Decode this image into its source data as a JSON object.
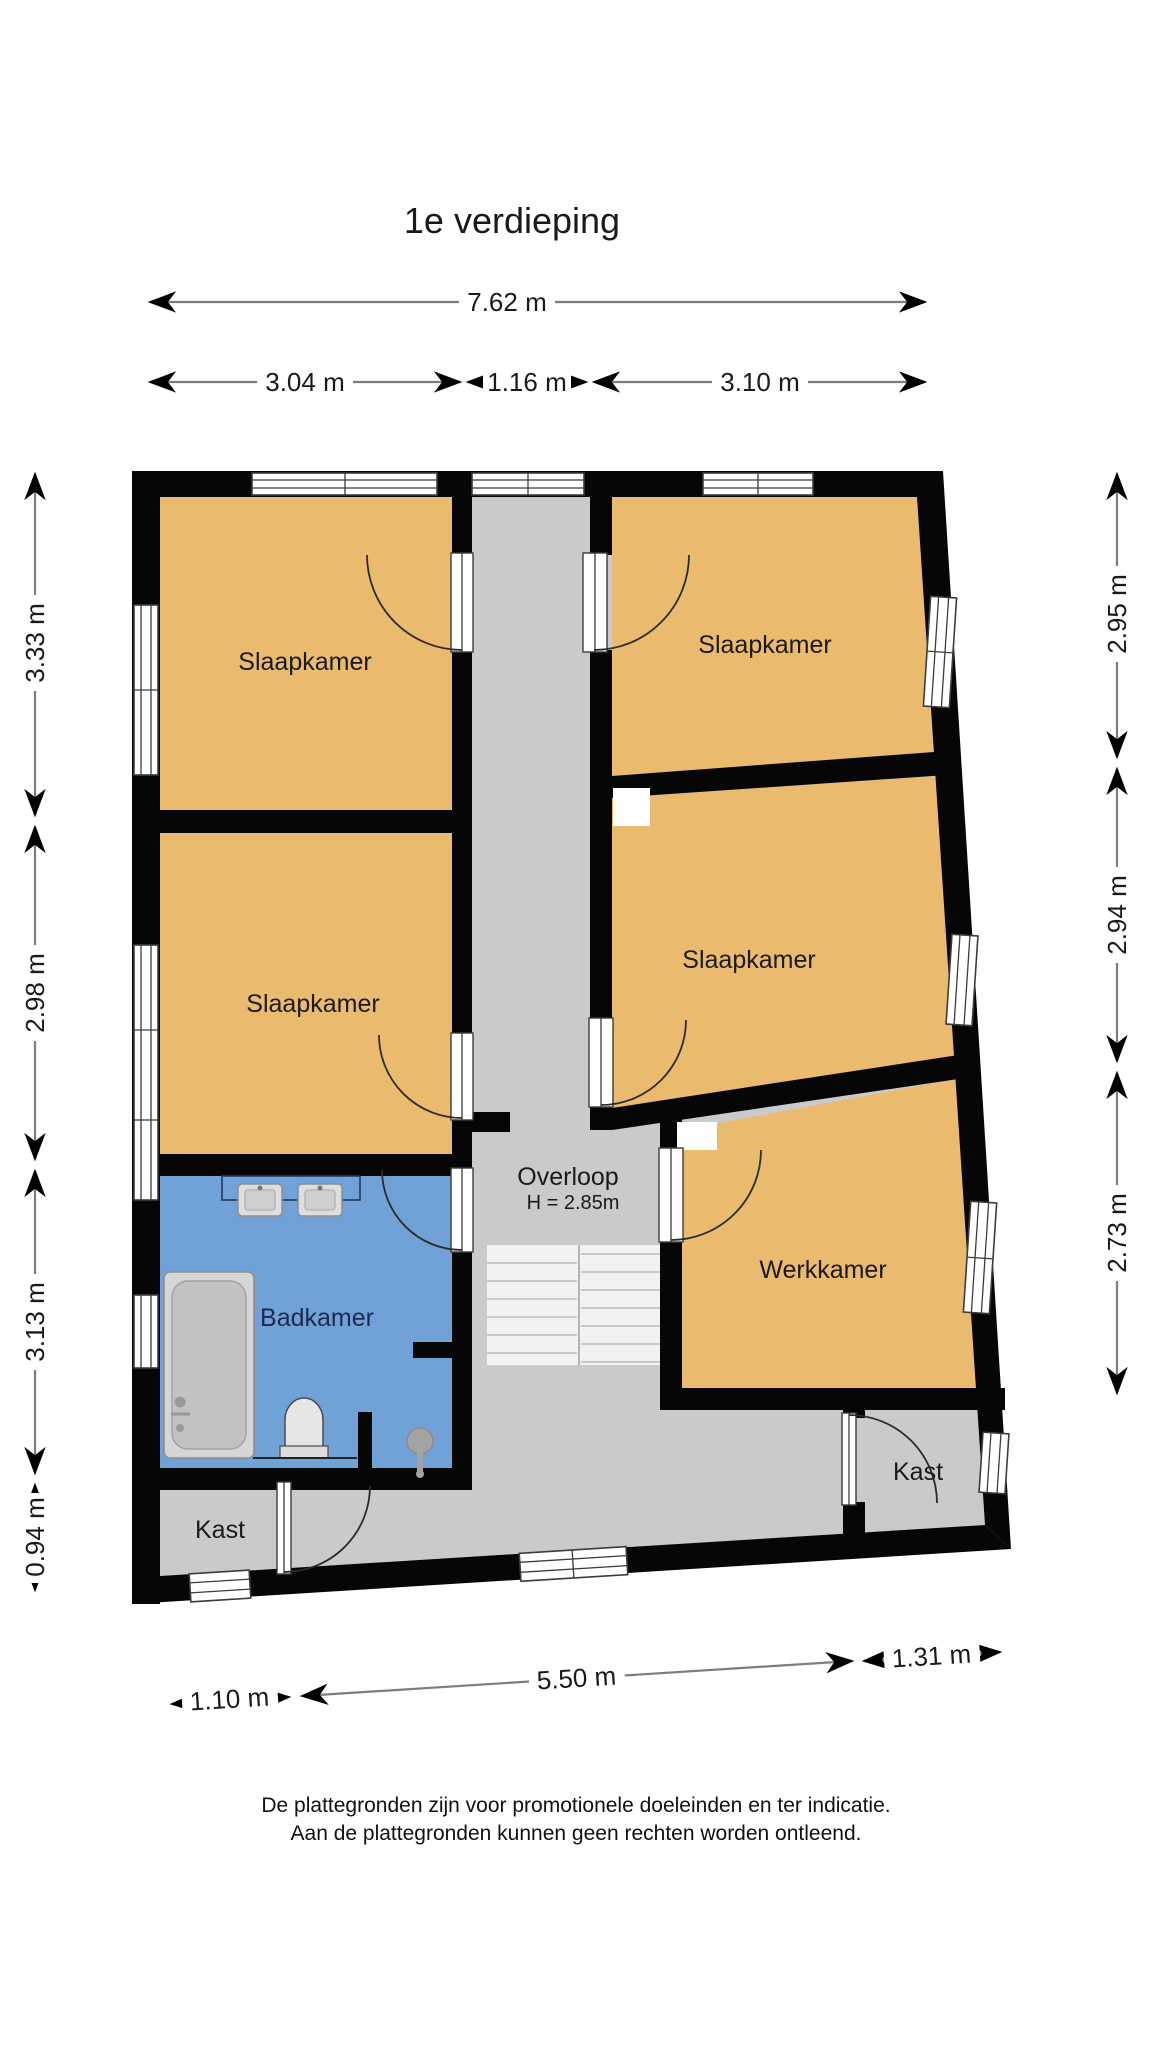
{
  "title": "1e verdieping",
  "dimensions": {
    "top_total": "7.62 m",
    "top_segments": [
      "3.04 m",
      "1.16 m",
      "3.10 m"
    ],
    "left": [
      "3.33 m",
      "2.98 m",
      "3.13 m",
      "0.94 m"
    ],
    "right": [
      "2.95 m",
      "2.94 m",
      "2.73 m"
    ],
    "bottom": [
      "1.10 m",
      "5.50 m",
      "1.31 m"
    ]
  },
  "rooms": {
    "bedroom_top_left": "Slaapkamer",
    "bedroom_top_right": "Slaapkamer",
    "bedroom_mid_left": "Slaapkamer",
    "bedroom_mid_right": "Slaapkamer",
    "workroom": "Werkkamer",
    "bathroom": "Badkamer",
    "landing": "Overloop",
    "landing_height": "H = 2.85m",
    "closet_left": "Kast",
    "closet_right": "Kast"
  },
  "footer": {
    "line1": "De plattegronden zijn voor promotionele doeleinden en ter indicatie.",
    "line2": "Aan de plattegronden kunnen geen rechten worden ontleend."
  },
  "colors": {
    "room_fill": "#eaba6e",
    "bathroom_fill": "#70a1d7",
    "hall_fill": "#cacaca",
    "stairs_fill": "#f2f2f2",
    "wall": "#060606"
  }
}
